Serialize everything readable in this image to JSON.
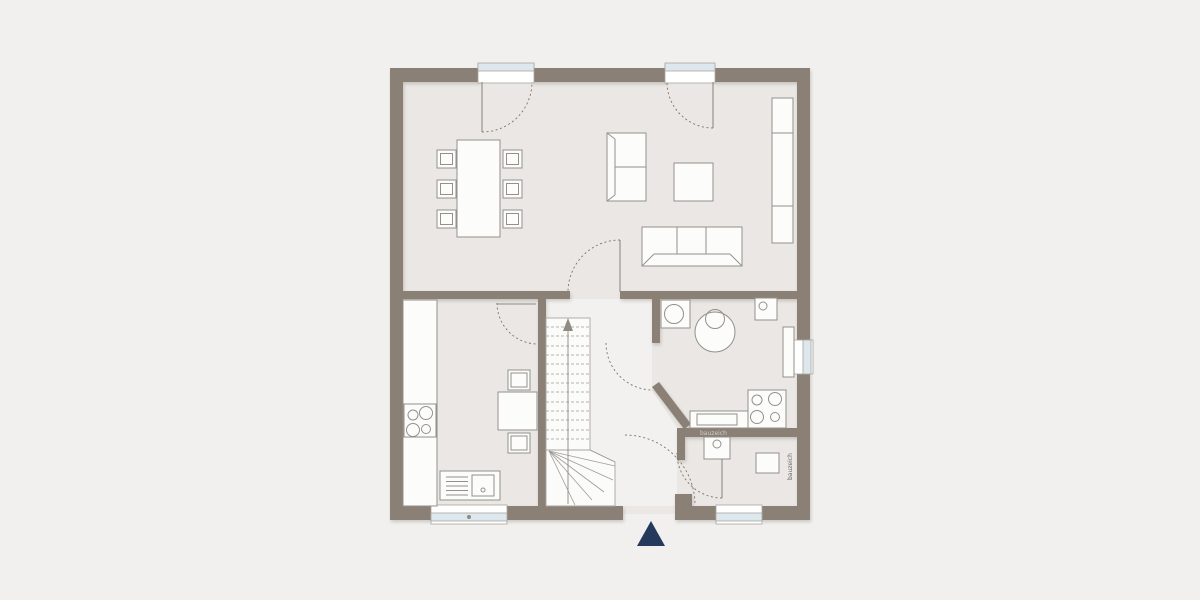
{
  "plan": {
    "type": "residential-ground-floor-plan",
    "watermark_horizontal": "bauzeich",
    "watermark_vertical": "bauzeich",
    "colors": {
      "background": "#f1f0ee",
      "floor": "#eae7e4",
      "hall_floor": "#f2f1ef",
      "wall": "#8a8076",
      "furniture_fill": "#fcfcfb",
      "furniture_stroke": "#95918a",
      "window_glass": "#dce8ee",
      "window_frame": "#a9a59e",
      "door_arc": "#7b7369",
      "stair_tread": "#a19c95",
      "entrance_marker": "#24395b",
      "watermark_light": "#d4cfc8",
      "watermark_dark": "#6e675e"
    },
    "symbols": {
      "dining_area": [
        "dining-table",
        "dining-chair x6"
      ],
      "living_area": [
        "sofa-2-seat",
        "sofa-3-seat",
        "coffee-table",
        "sideboard"
      ],
      "kitchen": [
        "kitchen-counter",
        "cooktop-4-burner",
        "kitchen-sink",
        "small-table",
        "chair x2"
      ],
      "utility_room": [
        "washing-machine",
        "round-basin",
        "hand-basin",
        "counter",
        "cooktop-4-burner",
        "radiator"
      ],
      "wc": [
        "washbasin",
        "toilet"
      ],
      "circulation": [
        "staircase-with-winders",
        "up-arrow",
        "door-swing-arc x7",
        "entrance-triangle-marker"
      ],
      "openings": [
        "terrace-door x2",
        "window-kitchen",
        "window-wc",
        "window-utility"
      ]
    }
  }
}
